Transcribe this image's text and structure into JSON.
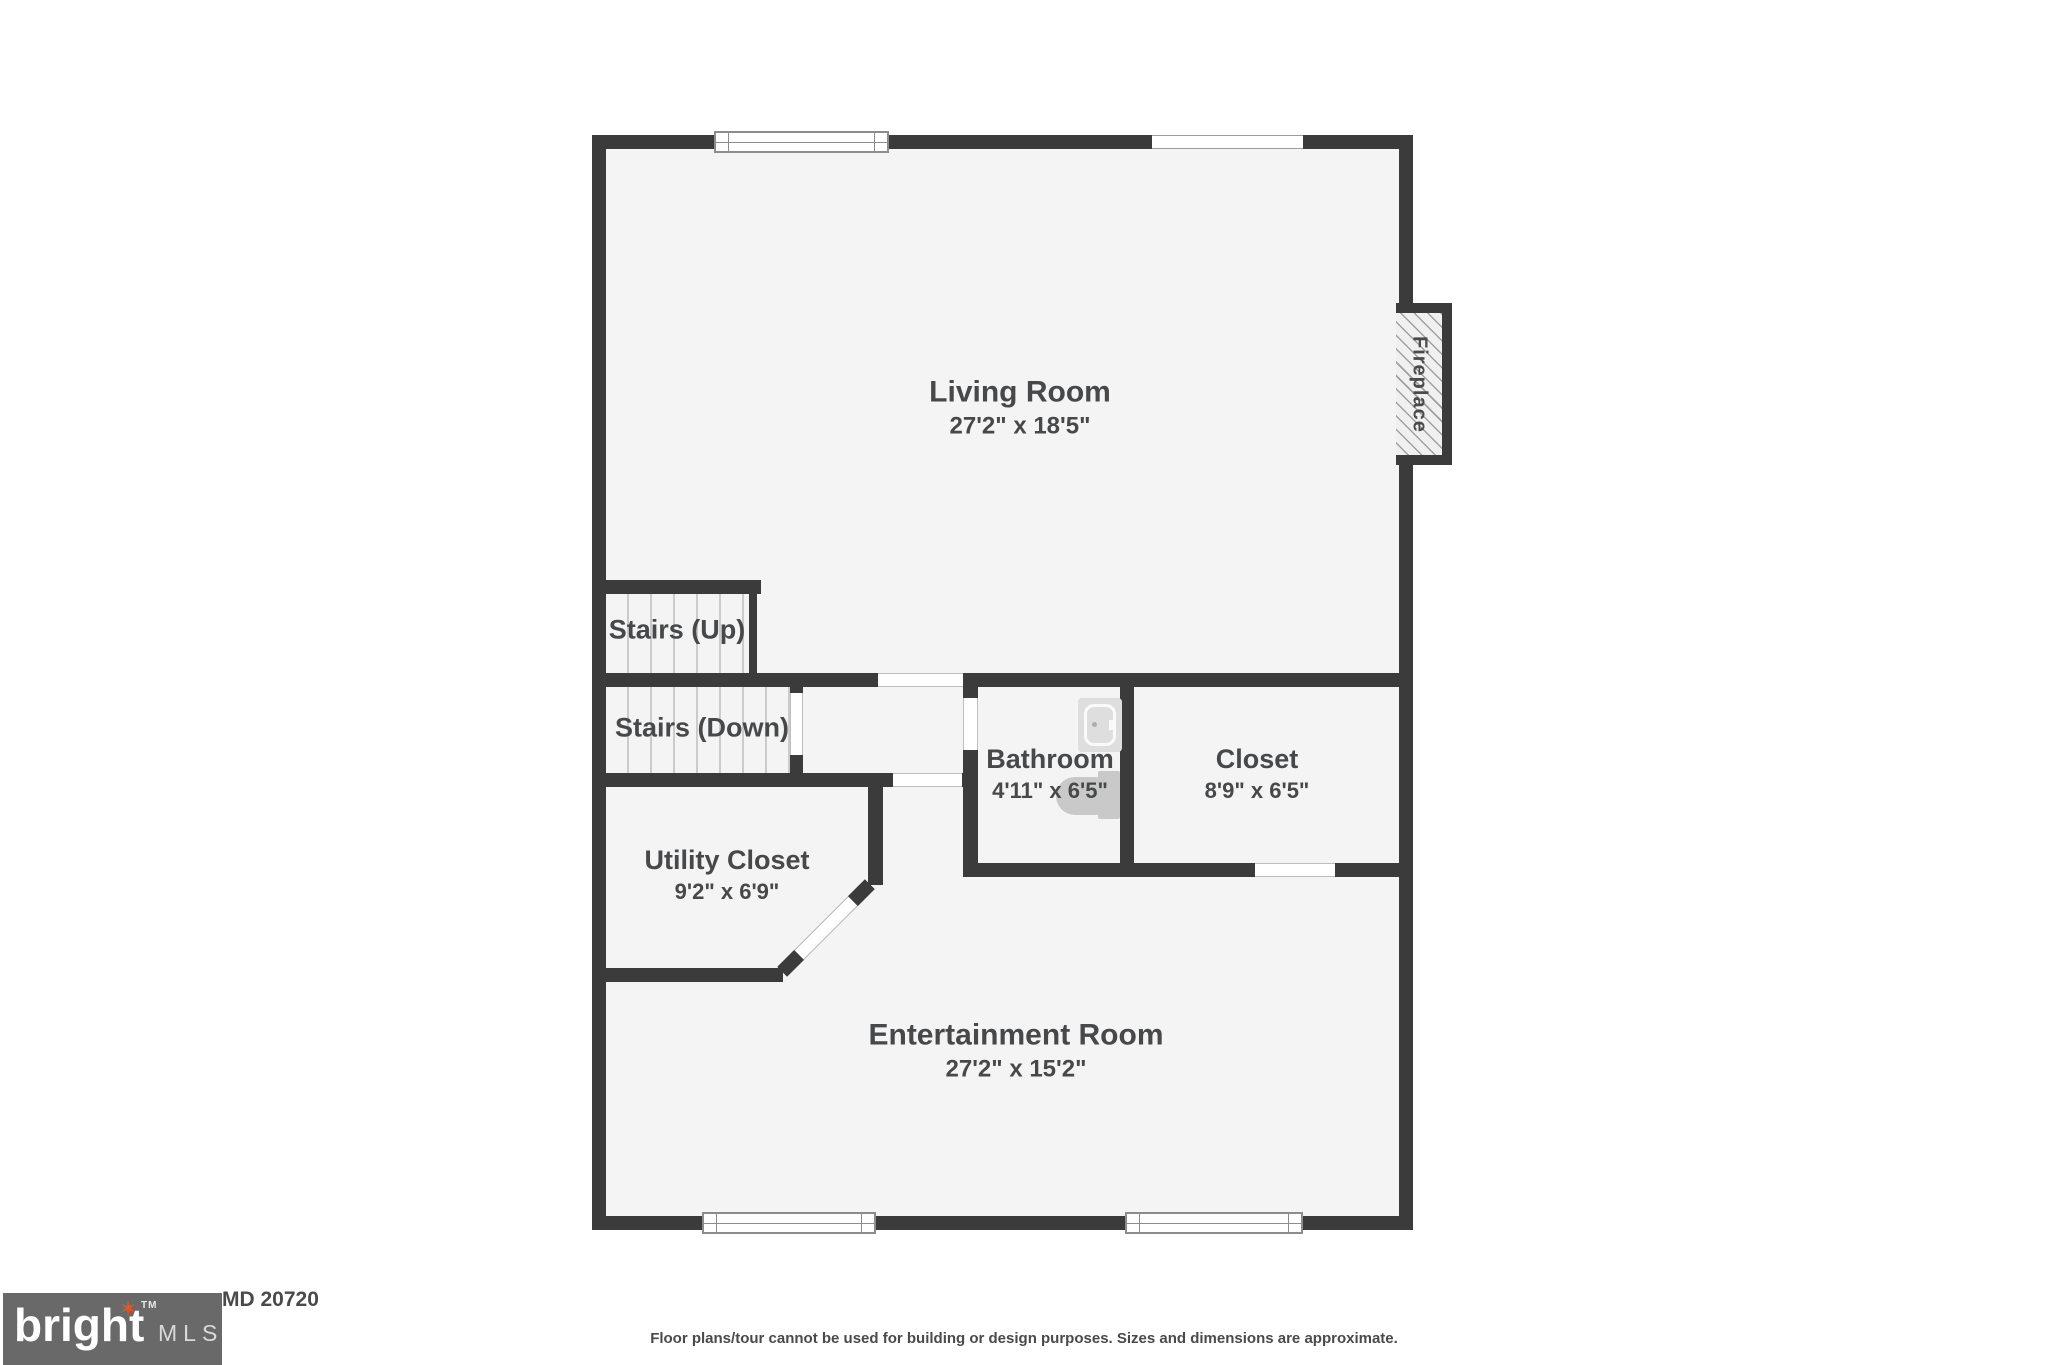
{
  "meta": {
    "type": "floor-plan",
    "colors": {
      "wall": "#3b3b3c",
      "floor": "#f4f4f4",
      "label_text": "#47484a",
      "logo_box": "#696969",
      "logo_accent_orange": "#e0562a"
    }
  },
  "rooms": {
    "living": {
      "name": "Living Room",
      "dims": "27'2\" x 18'5\""
    },
    "stairs_up": {
      "name": "Stairs (Up)"
    },
    "stairs_down": {
      "name": "Stairs (Down)"
    },
    "bathroom": {
      "name": "Bathroom",
      "dims": "4'11\" x 6'5\""
    },
    "closet": {
      "name": "Closet",
      "dims": "8'9\" x 6'5\""
    },
    "utility": {
      "name": "Utility Closet",
      "dims": "9'2\" x 6'9\""
    },
    "entertainment": {
      "name": "Entertainment Room",
      "dims": "27'2\" x 15'2\""
    }
  },
  "fireplace_label": "Fireplace",
  "footer": {
    "logo_text": "bright",
    "logo_tm": "TM",
    "logo_sub": "MLS",
    "address_visible": "MD 20720",
    "disclaimer": "Floor plans/tour cannot be used for building or design purposes. Sizes and dimensions are approximate."
  }
}
